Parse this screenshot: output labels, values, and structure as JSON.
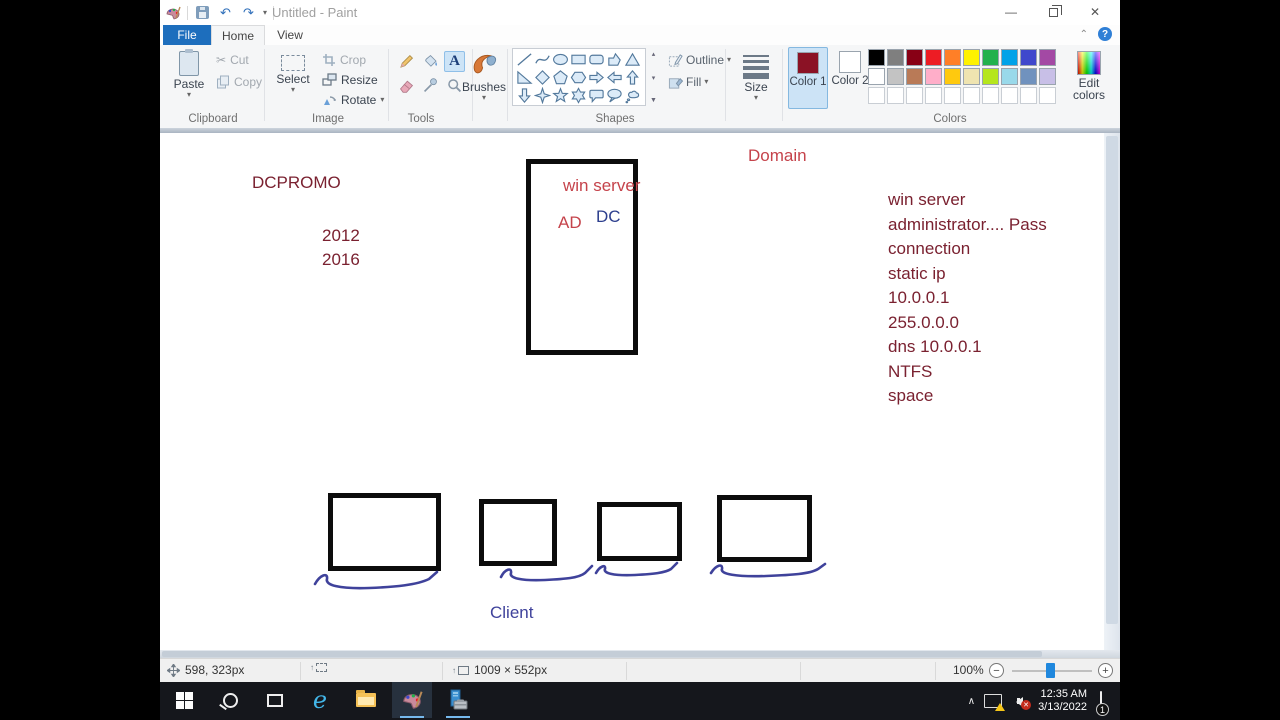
{
  "window": {
    "title": "Untitled - Paint"
  },
  "tabs": {
    "file": "File",
    "home": "Home",
    "view": "View"
  },
  "ribbon": {
    "clipboard": {
      "label": "Clipboard",
      "paste": "Paste",
      "cut": "Cut",
      "copy": "Copy"
    },
    "image": {
      "label": "Image",
      "select": "Select",
      "crop": "Crop",
      "resize": "Resize",
      "rotate": "Rotate"
    },
    "tools": {
      "label": "Tools"
    },
    "brushes": {
      "label": "Brushes"
    },
    "shapes": {
      "label": "Shapes",
      "outline": "Outline",
      "fill": "Fill",
      "items": [
        "line",
        "curve",
        "ellipse",
        "rectangle",
        "rounded-rectangle",
        "polygon",
        "triangle",
        "right-triangle",
        "diamond",
        "pentagon",
        "hexagon",
        "arrow-right",
        "arrow-left",
        "arrow-up",
        "arrow-down",
        "four-point-star",
        "five-point-star",
        "six-point-star",
        "rounded-callout",
        "oval-callout",
        "cloud-callout"
      ]
    },
    "size": {
      "label": "Size"
    },
    "colors": {
      "label": "Colors",
      "color1": "Color 1",
      "color2": "Color 2",
      "edit": "Edit colors",
      "color1_value": "#8b1225",
      "color2_value": "#ffffff",
      "row1": [
        "#000000",
        "#7f7f7f",
        "#880015",
        "#ed1c24",
        "#ff7f27",
        "#fff200",
        "#22b14c",
        "#00a2e8",
        "#3f48cc",
        "#a349a4"
      ],
      "row2": [
        "#ffffff",
        "#c3c3c3",
        "#b97a57",
        "#ffaec9",
        "#ffc90e",
        "#efe4b0",
        "#b5e61d",
        "#99d9ea",
        "#7092be",
        "#c8bfe7"
      ],
      "row3_empty_count": 10
    }
  },
  "canvas": {
    "dcpromo": "DCPROMO",
    "year1": "2012",
    "year2": "2016",
    "domain": "Domain",
    "server_title": "win server",
    "ad": "AD",
    "dc": "DC",
    "client": "Client",
    "notes": [
      "win server",
      "administrator.... Pass",
      "connection",
      "static ip",
      "10.0.0.1",
      "255.0.0.0",
      "dns 10.0.0.1",
      "NTFS",
      "space"
    ],
    "ink": {
      "maroon": "#7a2130",
      "crimson": "#c5434b",
      "navy": "#2d3f8e",
      "indigo": "#3f429b"
    }
  },
  "status": {
    "cursor": "598, 323px",
    "size": "1009 × 552px",
    "zoom": "100%"
  },
  "taskbar": {
    "time": "12:35 AM",
    "date": "3/13/2022",
    "notification_count": "1"
  }
}
